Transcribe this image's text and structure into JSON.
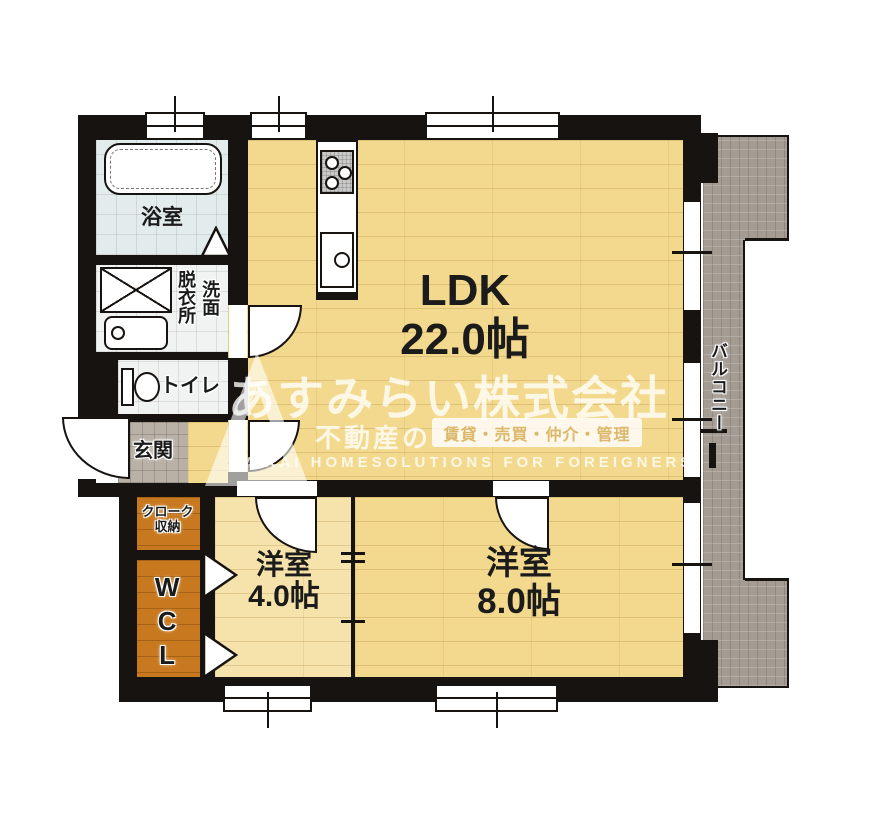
{
  "rooms": {
    "ldk": {
      "name": "LDK",
      "size": "22.0帖"
    },
    "bedroom_small": {
      "name": "洋室",
      "size": "4.0帖"
    },
    "bedroom_large": {
      "name": "洋室",
      "size": "8.0帖"
    },
    "bathroom": {
      "name": "浴室"
    },
    "washroom": {
      "label_left": "脱衣所",
      "label_right": "洗面"
    },
    "toilet": {
      "name": "トイレ"
    },
    "entrance": {
      "name": "玄関"
    },
    "cloak": {
      "line1": "クローク",
      "line2": "収納"
    },
    "wcl": {
      "name": "WCL"
    },
    "balcony": {
      "name": "バルコニー"
    }
  },
  "watermark": {
    "company": "あすみらい株式会社",
    "prefix": "不動産の",
    "services": "賃貸・売買・仲介・管理",
    "english": "MIRAI HOMESOLUTIONS FOR FOREIGNERS"
  },
  "colors": {
    "wall": "#171310",
    "floor_wood": "#f3d98e",
    "floor_wood_light": "#f6e3ab",
    "closet_wood": "#c8781e",
    "bath_tile": "#e3ecec",
    "entrance_tile": "#b9b1a6",
    "balcony_gray": "#a49b93",
    "watermark_accent": "#dcb86a"
  }
}
